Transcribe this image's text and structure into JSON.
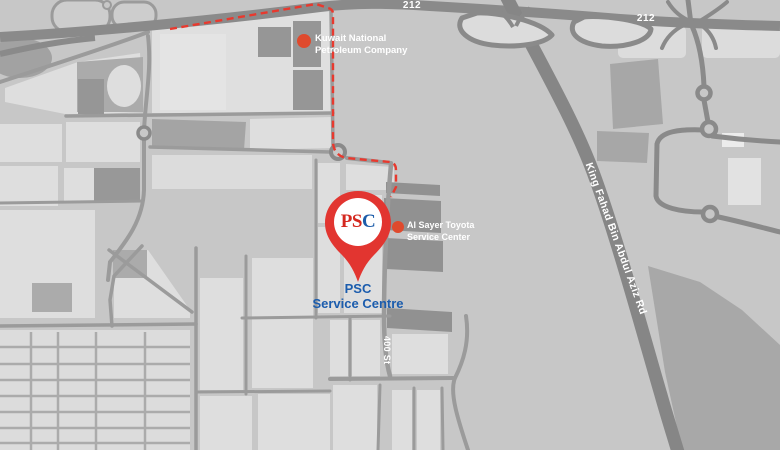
{
  "map": {
    "highway_labels": {
      "west": "212",
      "east": "212"
    },
    "road_labels": {
      "king_fahad": "King Fahad Bin Abdul Aziz Rd",
      "street_400": "400 St"
    },
    "markers": {
      "knpc": {
        "line1": "Kuwait National",
        "line2": "Petroleum Company"
      },
      "al_sayer": {
        "line1": "Al Sayer Toyota",
        "line2": "Service Center"
      },
      "psc": {
        "pin_letters": [
          "P",
          "S",
          "C"
        ],
        "caption_line1": "PSC",
        "caption_line2": "Service Centre"
      }
    },
    "colors": {
      "background": "#c7c7c7",
      "block_light": "#dedede",
      "road_minor": "#9b9b9b",
      "road_major": "#868686",
      "building_dark": "#949494",
      "boundary_red": "#e8392e",
      "marker_dot_red": "#df4a2d",
      "pin_red": "#e23530",
      "psc_letter_red": "#d4281f",
      "psc_letter_blue": "#1c5ca9",
      "caption_blue": "#1b5cad"
    }
  }
}
